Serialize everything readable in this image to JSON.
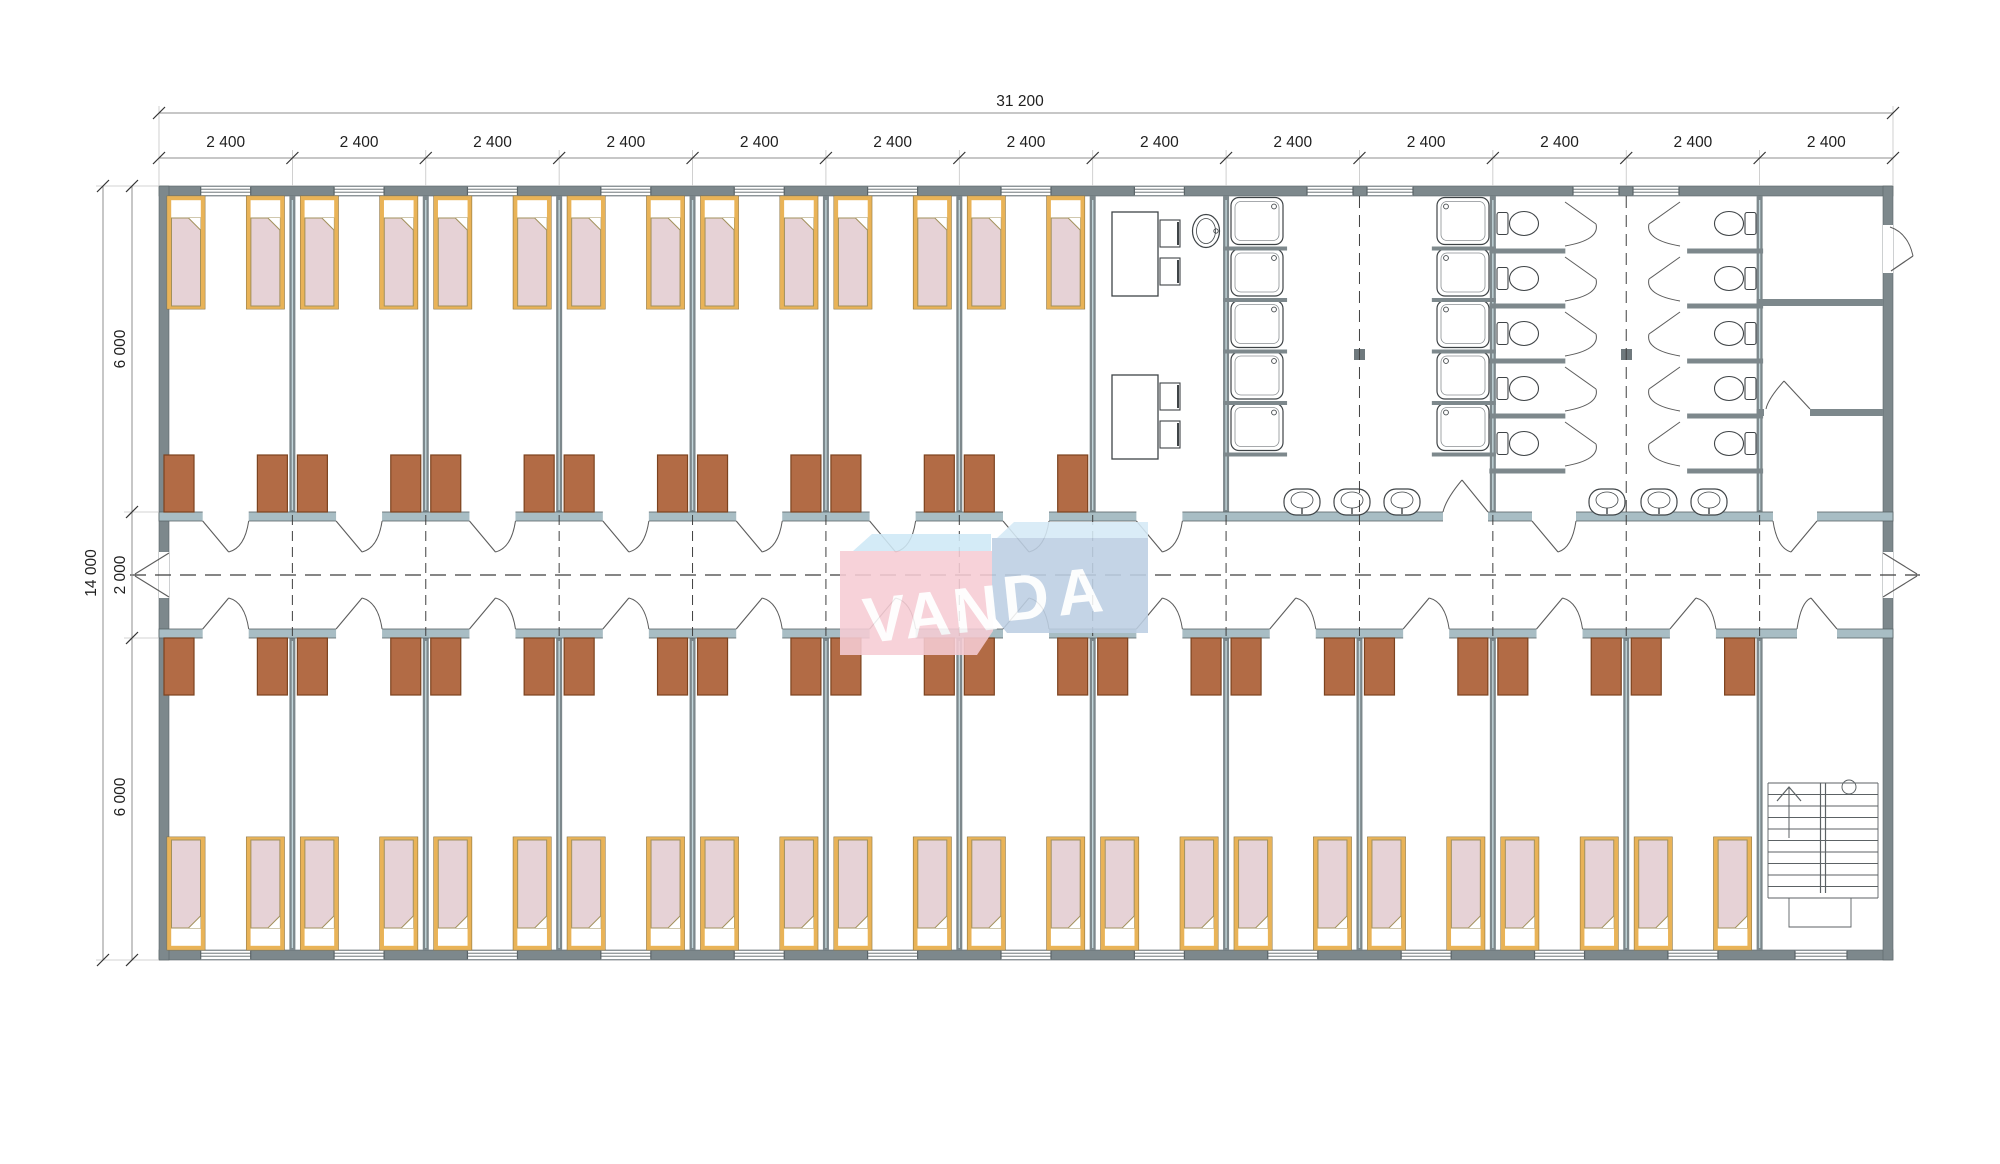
{
  "dimensions": {
    "top_total_label": "31 200",
    "top_segment_labels": [
      "2 400",
      "2 400",
      "2 400",
      "2 400",
      "2 400",
      "2 400",
      "2 400",
      "2 400",
      "2 400",
      "2 400",
      "2 400",
      "2 400",
      "2 400"
    ],
    "left_total_label": "14 000",
    "left_segment_labels": [
      "6 000",
      "2 000",
      "6 000"
    ]
  },
  "logo": {
    "text": "VANDA",
    "part1": "VAN",
    "part2": "DA",
    "part1_bg": "#f6ccd4",
    "part1_top": "#cfe9f6",
    "part2_bg": "#bdcfe3",
    "part2_top": "#d6eaf6",
    "text_color": "#ffffff"
  },
  "colors": {
    "background": "#ffffff",
    "wall": "#7d888c",
    "corridor_wall": "#a8bdc4",
    "wall_outline": "#5a6468",
    "partition_core": "#c2d5da",
    "bed_frame": "#e9b357",
    "bed_frame_outline": "#8c7340",
    "mattress": "#e6d2d6",
    "mattress_outline": "#a2905c",
    "wardrobe": "#b26b45",
    "wardrobe_outline": "#7c431f",
    "fixture_line": "#3f4447",
    "door_line": "#5c5c5c",
    "dash_line": "#3f3f3f",
    "dim_line": "#8f8f8f",
    "dim_text": "#1f1f1f",
    "column": "#6f797d"
  },
  "plan": {
    "modules": 13,
    "module_width_label": "2 400",
    "bedrooms_top_row": 7,
    "bedrooms_bottom_row": 12,
    "beds_per_room": 2,
    "total_beds": 38,
    "total_wardrobes": 38,
    "shower_trays": 10,
    "toilet_stalls": 10,
    "wash_basins": 6,
    "dining_tables": 2,
    "chairs": 4,
    "laundry_sinks": 1,
    "structural_columns": 2,
    "stairwell_location": "bottom-right",
    "corridor_position": "center"
  }
}
